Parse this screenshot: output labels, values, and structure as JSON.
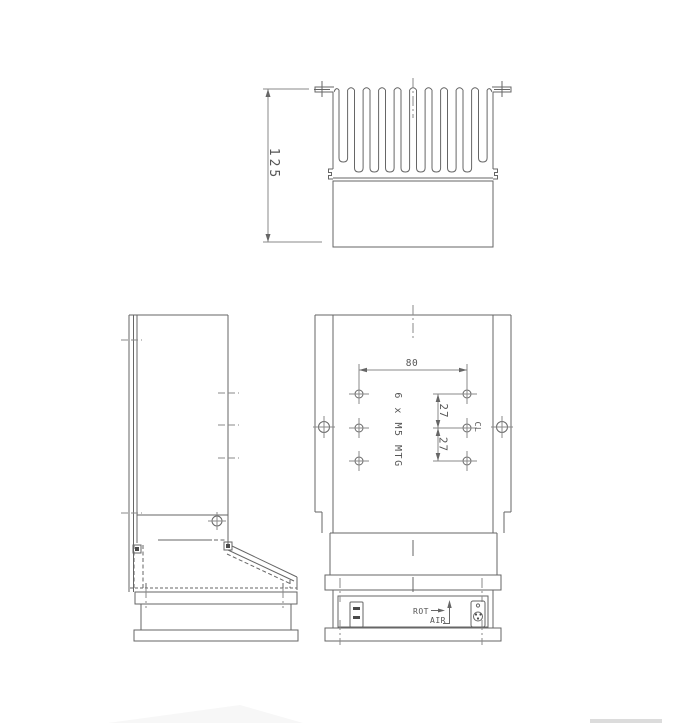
{
  "page": {
    "background": "#ffffff"
  },
  "drawing": {
    "line_color": "#666666",
    "dim_line_color": "#8a8a8a",
    "text_color": "#555555",
    "section_view": {
      "height_dim": "125"
    },
    "front_view": {
      "width_dim": "80",
      "row_dim_upper": "27",
      "row_dim_lower": "27",
      "mtg_note": "6 x M5 MTG",
      "cl_label": "CL",
      "rot_label": "ROT",
      "air_label": "AIR"
    }
  }
}
